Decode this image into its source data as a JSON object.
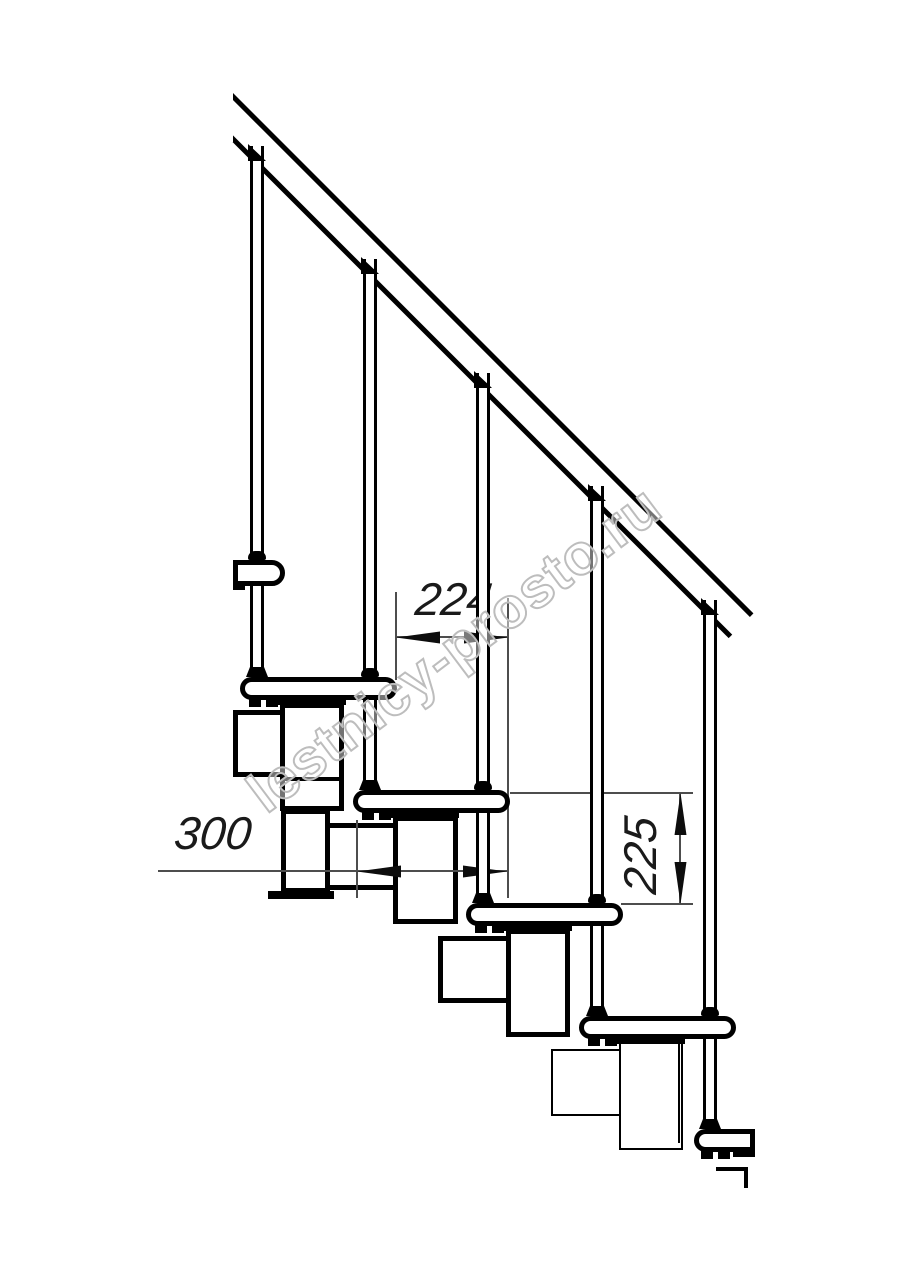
{
  "title": "Modular staircase side-view technical drawing",
  "watermark": {
    "text": "lestnicy-prosto.ru"
  },
  "dimensions": {
    "tread_run": {
      "value": "224"
    },
    "tread_depth": {
      "value": "300"
    },
    "step_rise": {
      "value": "225"
    }
  },
  "colors": {
    "line": "#000000",
    "dim": "#4d4d4d",
    "watermark": "#bdbdbd"
  }
}
